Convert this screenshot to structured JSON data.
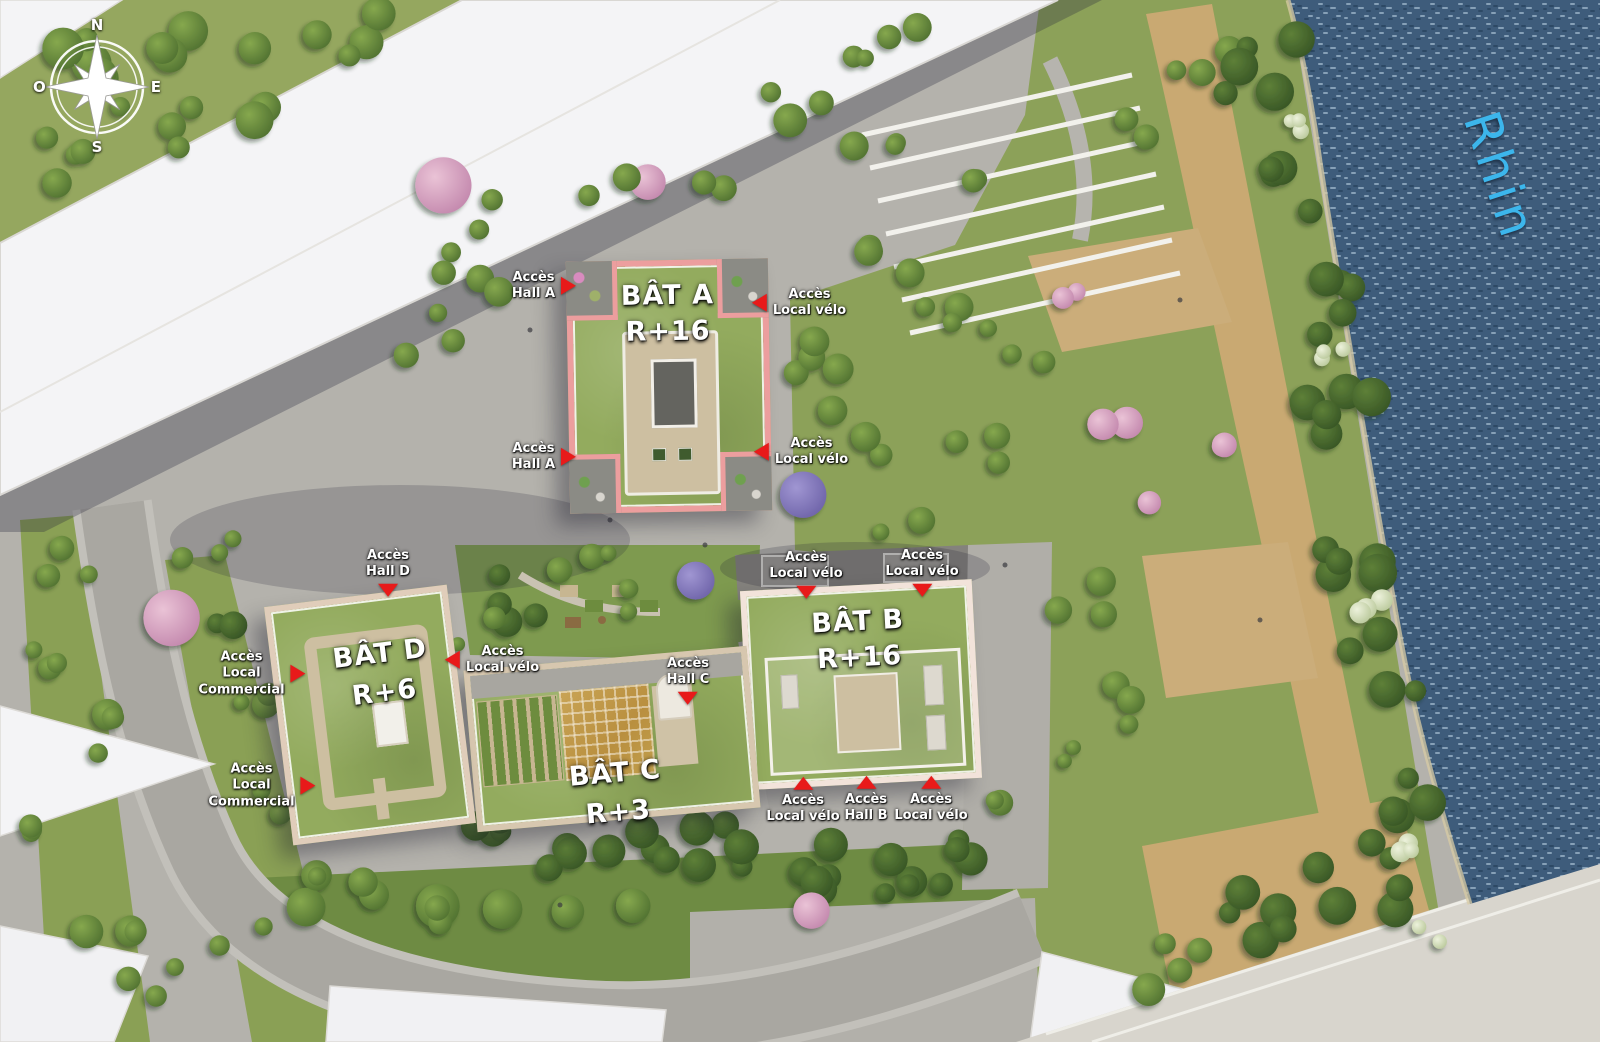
{
  "compass": {
    "n": "N",
    "e": "E",
    "s": "S",
    "o": "O"
  },
  "river": {
    "label": "Rhin",
    "text_color": "#3CB6EC"
  },
  "buildings": [
    {
      "id": "bat-a",
      "name": "BÂT A",
      "floors": "R+16",
      "outline_color": "#EC9E9E"
    },
    {
      "id": "bat-b",
      "name": "BÂT B",
      "floors": "R+16",
      "outline_color": "#F2E3DA"
    },
    {
      "id": "bat-c",
      "name": "BÂT C",
      "floors": "R+3",
      "outline_color": "#D7C7AF"
    },
    {
      "id": "bat-d",
      "name": "BÂT D",
      "floors": "R+6",
      "outline_color": "#E0CDBA"
    }
  ],
  "access_points": [
    {
      "id": "acces-hall-a-nord",
      "lines": [
        "Accès",
        "Hall A"
      ]
    },
    {
      "id": "acces-hall-a-sud",
      "lines": [
        "Accès",
        "Hall A"
      ]
    },
    {
      "id": "acces-local-velo-a-nord",
      "lines": [
        "Accès",
        "Local vélo"
      ]
    },
    {
      "id": "acces-local-velo-a-sud",
      "lines": [
        "Accès",
        "Local vélo"
      ]
    },
    {
      "id": "acces-local-velo-b-nord-ouest",
      "lines": [
        "Accès",
        "Local vélo"
      ]
    },
    {
      "id": "acces-local-velo-b-nord-est",
      "lines": [
        "Accès",
        "Local vélo"
      ]
    },
    {
      "id": "acces-local-velo-b-sud-ouest",
      "lines": [
        "Accès",
        "Local vélo"
      ]
    },
    {
      "id": "acces-hall-b",
      "lines": [
        "Accès",
        "Hall B"
      ]
    },
    {
      "id": "acces-local-velo-b-sud-est",
      "lines": [
        "Accès",
        "Local vélo"
      ]
    },
    {
      "id": "acces-hall-d",
      "lines": [
        "Accès",
        "Hall D"
      ]
    },
    {
      "id": "acces-local-commercial-1",
      "lines": [
        "Accès",
        "Local",
        "Commercial"
      ]
    },
    {
      "id": "acces-local-commercial-2",
      "lines": [
        "Accès",
        "Local",
        "Commercial"
      ]
    },
    {
      "id": "acces-local-velo-d",
      "lines": [
        "Accès",
        "Local vélo"
      ]
    },
    {
      "id": "acces-hall-c",
      "lines": [
        "Accès",
        "Hall C"
      ]
    }
  ],
  "colors": {
    "arrow_red": "#E81A1A",
    "water": "#3E5C7B",
    "roof_green": "#93AB5E",
    "plaza_gray": "#B4B2AC"
  }
}
